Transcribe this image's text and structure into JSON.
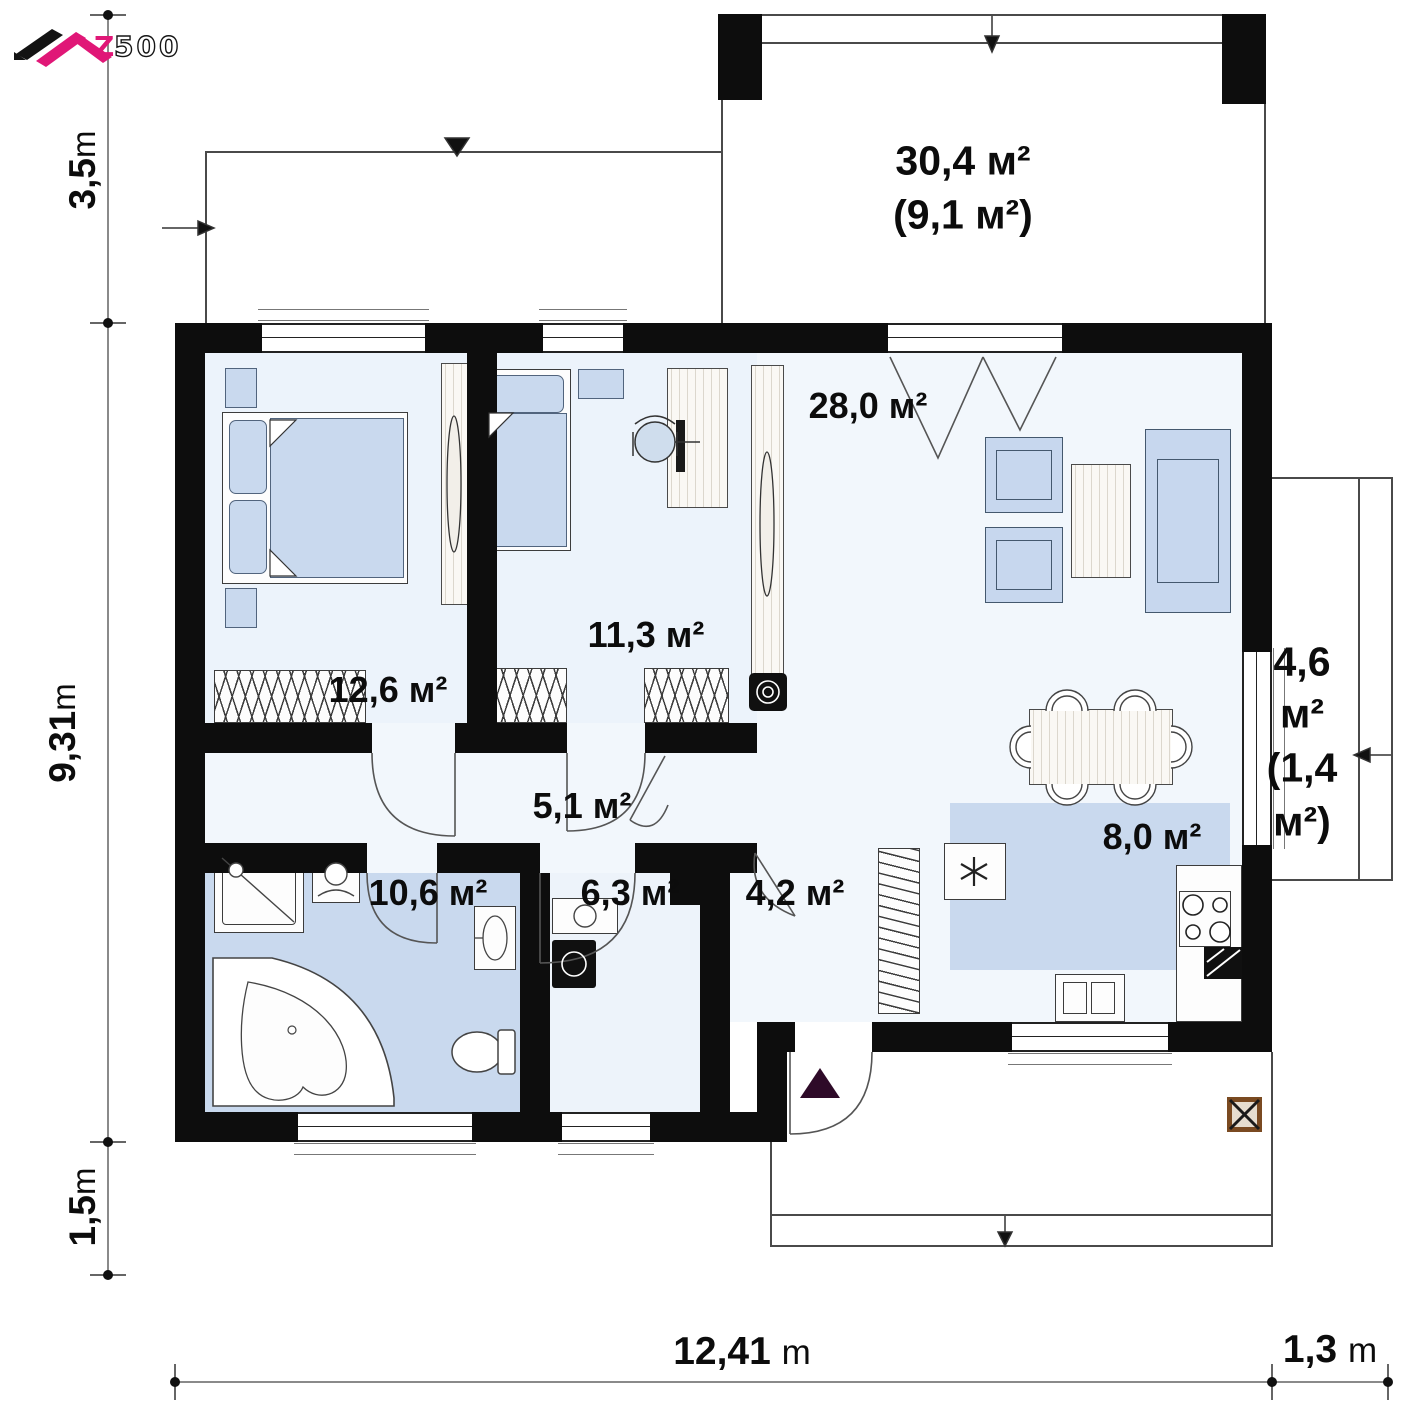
{
  "logo": {
    "brand_z": "Z",
    "brand_rest": "500"
  },
  "dimensions": {
    "left": [
      {
        "value": "3,5",
        "unit": "m"
      },
      {
        "value": "9,31",
        "unit": "m"
      },
      {
        "value": "1,5",
        "unit": "m"
      }
    ],
    "bottom": [
      {
        "value": "12,41",
        "unit": "m"
      },
      {
        "value": "1,3",
        "unit": "m"
      }
    ]
  },
  "rooms": {
    "terrace_top": {
      "area": "30,4 м²",
      "area_secondary": "(9,1 м²)"
    },
    "living": {
      "area": "28,0 м²"
    },
    "bedroom1": {
      "area": "12,6 м²"
    },
    "bedroom2": {
      "area": "11,3 м²"
    },
    "hall": {
      "area": "5,1 м²"
    },
    "bathroom": {
      "area": "10,6 м²"
    },
    "utility": {
      "area": "6,3 м²"
    },
    "vestibule": {
      "area": "4,2 м²"
    },
    "kitchen": {
      "area": "8,0 м²"
    },
    "terrace_right": {
      "lines": [
        "4,6",
        "м²",
        "(1,4",
        "м²)"
      ]
    }
  },
  "colors": {
    "wall": "#0d0d0d",
    "floor_light": "#f2f7fc",
    "floor_blue": "#c9d9ee",
    "brand_pink": "#e01777",
    "entrance_marker": "#2e0a28"
  }
}
